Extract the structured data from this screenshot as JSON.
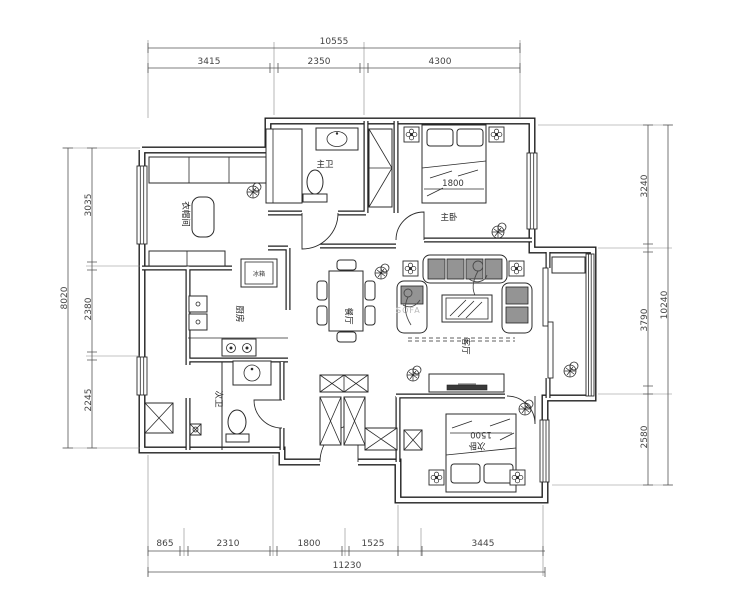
{
  "canvas": {
    "width": 740,
    "height": 600
  },
  "colors": {
    "line": "#1f1f1f",
    "background": "#ffffff",
    "dimension": "#555555",
    "cushion": "#949494",
    "watermark": "#b9b9b9"
  },
  "dimensions": {
    "top": {
      "total": "10555",
      "segments": [
        "3415",
        "2350",
        "4300"
      ]
    },
    "left": {
      "total": "8020",
      "segments": [
        "3035",
        "2380",
        "2245"
      ]
    },
    "right": {
      "total": "10240",
      "segments": [
        "3240",
        "3790",
        "2580"
      ]
    },
    "bottom": {
      "total": "11230",
      "segments": [
        "865",
        "2310",
        "1800",
        "1525",
        "3445"
      ]
    }
  },
  "rooms": {
    "cloakroom": "衣帽间",
    "master_bath": "主卫",
    "master_bedroom": "主卧",
    "kitchen": "厨房",
    "dining": "餐厅",
    "living": "客厅",
    "second_bath": "次卫",
    "second_bedroom": "次卧"
  },
  "furniture_labels": {
    "fridge": "冰箱",
    "master_bed_width": "1800",
    "second_bed_width": "1500",
    "sofa_watermark": "SOFA"
  }
}
